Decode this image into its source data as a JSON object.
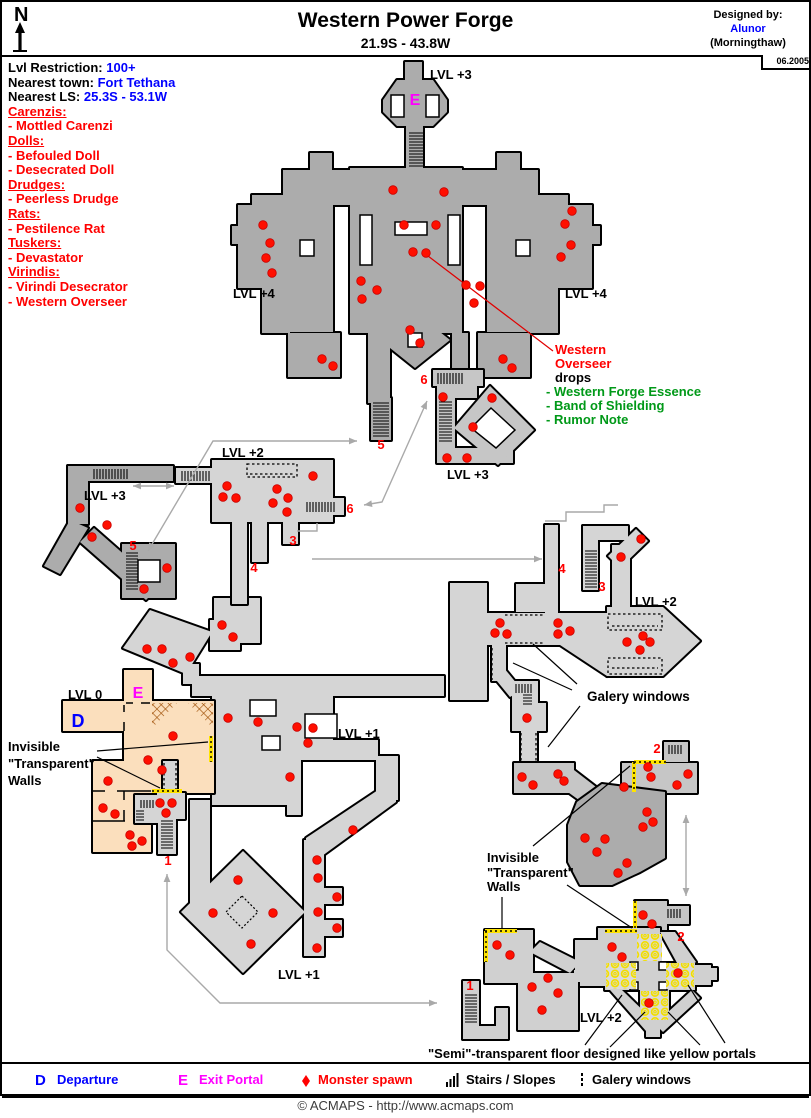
{
  "header": {
    "compass": "N",
    "title": "Western Power Forge",
    "coords": "21.9S - 43.8W",
    "designed_by": "Designed by:",
    "designer": "Alunor",
    "designer_world": "(Morningthaw)",
    "date": "06.2005"
  },
  "info": {
    "restriction_label": "Lvl Restriction:",
    "restriction": "100+",
    "town_label": "Nearest town:",
    "town": "Fort Tethana",
    "ls_label": "Nearest LS:",
    "ls": "25.3S - 53.1W"
  },
  "bestiary": [
    {
      "heading": "Carenzis:",
      "items": [
        "- Mottled Carenzi"
      ]
    },
    {
      "heading": "Dolls:",
      "items": [
        "- Befouled Doll",
        "- Desecrated Doll"
      ]
    },
    {
      "heading": "Drudges:",
      "items": [
        "- Peerless Drudge"
      ]
    },
    {
      "heading": "Rats:",
      "items": [
        "- Pestilence Rat"
      ]
    },
    {
      "heading": "Tuskers:",
      "items": [
        "- Devastator"
      ]
    },
    {
      "heading": "Virindis:",
      "items": [
        "- Virindi Desecrator",
        "- Western Overseer"
      ]
    }
  ],
  "annotations": {
    "overseer_name_1": "Western",
    "overseer_name_2": "Overseer",
    "overseer_drops_label": "drops",
    "overseer_drops": [
      "- Western Forge Essence",
      "- Band of Shielding",
      "- Rumor Note"
    ],
    "invisible_1": "Invisible",
    "invisible_2": "\"Transparent\"",
    "invisible_3": "Walls",
    "galery": "Galery windows",
    "semi_floor": "\"Semi\"-transparent floor designed like yellow portals"
  },
  "legend": {
    "departure_key": "D",
    "departure": "Departure",
    "exit_key": "E",
    "exit": "Exit Portal",
    "monster": "Monster spawn",
    "stairs": "Stairs / Slopes",
    "galery": "Galery windows"
  },
  "footer": {
    "copyright": "© ACMAPS - http://www.acmaps.com"
  },
  "map": {
    "colors": {
      "dark_gray": "#ACACAC",
      "mid_gray": "#C6C6C6",
      "light_gray": "#D5D5D5",
      "peach": "#FBDFBD",
      "spawn_red": "#FF0F00",
      "wall_yellow": "#FFE400",
      "arrow_gray": "#A9A9A9",
      "exit_magenta": "#FF00FF",
      "departure_blue": "#0000FF",
      "drops_green": "#009918"
    },
    "labels": [
      {
        "t": "LVL +3",
        "x": 430,
        "y": 79,
        "c": "k",
        "a": "s"
      },
      {
        "t": "LVL +4",
        "x": 233,
        "y": 298,
        "c": "k",
        "a": "s"
      },
      {
        "t": "LVL +4",
        "x": 565,
        "y": 298,
        "c": "k",
        "a": "s"
      },
      {
        "t": "LVL +3",
        "x": 447,
        "y": 479,
        "c": "k",
        "a": "s"
      },
      {
        "t": "LVL +3",
        "x": 84,
        "y": 500,
        "c": "k",
        "a": "s"
      },
      {
        "t": "LVL +2",
        "x": 222,
        "y": 457,
        "c": "k",
        "a": "s"
      },
      {
        "t": "LVL +2",
        "x": 635,
        "y": 606,
        "c": "k",
        "a": "s"
      },
      {
        "t": "LVL +1",
        "x": 338,
        "y": 738,
        "c": "k",
        "a": "s"
      },
      {
        "t": "LVL 0",
        "x": 68,
        "y": 699,
        "c": "k",
        "a": "s"
      },
      {
        "t": "LVL +1",
        "x": 278,
        "y": 979,
        "c": "k",
        "a": "s"
      },
      {
        "t": "LVL +2",
        "x": 580,
        "y": 1022,
        "c": "k",
        "a": "s"
      },
      {
        "t": "5",
        "x": 381,
        "y": 449,
        "c": "r",
        "a": "m"
      },
      {
        "t": "5",
        "x": 133,
        "y": 550,
        "c": "r",
        "a": "m"
      },
      {
        "t": "6",
        "x": 424,
        "y": 384,
        "c": "r",
        "a": "m"
      },
      {
        "t": "6",
        "x": 350,
        "y": 513,
        "c": "r",
        "a": "m"
      },
      {
        "t": "3",
        "x": 293,
        "y": 545,
        "c": "r",
        "a": "m"
      },
      {
        "t": "4",
        "x": 254,
        "y": 572,
        "c": "r",
        "a": "m"
      },
      {
        "t": "4",
        "x": 562,
        "y": 573,
        "c": "r",
        "a": "m"
      },
      {
        "t": "3",
        "x": 602,
        "y": 591,
        "c": "r",
        "a": "m"
      },
      {
        "t": "1",
        "x": 168,
        "y": 865,
        "c": "r",
        "a": "m"
      },
      {
        "t": "1",
        "x": 470,
        "y": 990,
        "c": "r",
        "a": "m"
      },
      {
        "t": "2",
        "x": 657,
        "y": 753,
        "c": "r",
        "a": "m"
      },
      {
        "t": "2",
        "x": 681,
        "y": 941,
        "c": "r",
        "a": "m"
      },
      {
        "t": "E",
        "x": 415,
        "y": 105,
        "c": "e",
        "a": "m"
      },
      {
        "t": "E",
        "x": 138,
        "y": 698,
        "c": "e",
        "a": "m"
      },
      {
        "t": "D",
        "x": 78,
        "y": 727,
        "c": "d",
        "a": "m"
      }
    ],
    "stairs": [
      [
        409,
        132,
        14,
        36,
        "v"
      ],
      [
        373,
        402,
        16,
        36,
        "v"
      ],
      [
        437,
        373,
        27,
        11,
        "h"
      ],
      [
        439,
        401,
        13,
        42,
        "v"
      ],
      [
        93,
        469,
        36,
        10,
        "h"
      ],
      [
        126,
        552,
        12,
        38,
        "v"
      ],
      [
        181,
        471,
        29,
        10,
        "h"
      ],
      [
        306,
        502,
        28,
        10,
        "h"
      ],
      [
        585,
        550,
        12,
        38,
        "v"
      ],
      [
        161,
        820,
        12,
        30,
        "v"
      ],
      [
        465,
        994,
        12,
        30,
        "v"
      ],
      [
        515,
        684,
        16,
        9,
        "h"
      ],
      [
        523,
        694,
        9,
        11,
        "v"
      ],
      [
        668,
        745,
        15,
        9,
        "h"
      ],
      [
        667,
        909,
        15,
        9,
        "h"
      ],
      [
        140,
        800,
        13,
        8,
        "h"
      ],
      [
        136,
        810,
        8,
        12,
        "v"
      ]
    ],
    "arrows": [
      {
        "pts": [
          [
            148,
            551
          ],
          [
            213,
            441
          ],
          [
            357,
            441
          ]
        ],
        "heads": "both"
      },
      {
        "pts": [
          [
            427,
            401
          ],
          [
            382,
            502
          ],
          [
            364,
            505
          ]
        ],
        "heads": "both"
      },
      {
        "pts": [
          [
            133,
            486
          ],
          [
            174,
            486
          ]
        ],
        "heads": "both"
      },
      {
        "pts": [
          [
            312,
            559
          ],
          [
            542,
            559
          ]
        ],
        "heads": "end"
      },
      {
        "pts": [
          [
            297,
            531
          ],
          [
            317,
            531
          ],
          [
            317,
            523
          ]
        ],
        "heads": "none"
      },
      {
        "pts": [
          [
            545,
            521
          ],
          [
            566,
            521
          ],
          [
            566,
            512
          ],
          [
            604,
            512
          ],
          [
            604,
            505
          ],
          [
            618,
            505
          ]
        ],
        "heads": "none"
      },
      {
        "pts": [
          [
            686,
            815
          ],
          [
            686,
            896
          ]
        ],
        "heads": "both"
      },
      {
        "pts": [
          [
            167,
            874
          ],
          [
            167,
            950
          ],
          [
            220,
            1003
          ],
          [
            437,
            1003
          ]
        ],
        "heads": "both"
      }
    ],
    "lines": [
      {
        "pts": [
          [
            97,
            751
          ],
          [
            208,
            742
          ]
        ],
        "c": "#000000"
      },
      {
        "pts": [
          [
            97,
            757
          ],
          [
            160,
            788
          ]
        ],
        "c": "#000000"
      },
      {
        "pts": [
          [
            533,
            846
          ],
          [
            630,
            766
          ]
        ],
        "c": "#000000"
      },
      {
        "pts": [
          [
            567,
            885
          ],
          [
            632,
            928
          ]
        ],
        "c": "#000000"
      },
      {
        "pts": [
          [
            502,
            897
          ],
          [
            502,
            928
          ]
        ],
        "c": "#000000"
      },
      {
        "pts": [
          [
            577,
            684
          ],
          [
            533,
            644
          ]
        ],
        "c": "#000000"
      },
      {
        "pts": [
          [
            572,
            690
          ],
          [
            513,
            663
          ]
        ],
        "c": "#000000"
      },
      {
        "pts": [
          [
            580,
            706
          ],
          [
            548,
            747
          ]
        ],
        "c": "#000000"
      },
      {
        "pts": [
          [
            622,
            995
          ],
          [
            585,
            1045
          ]
        ],
        "c": "#000000"
      },
      {
        "pts": [
          [
            645,
            1012
          ],
          [
            610,
            1047
          ]
        ],
        "c": "#000000"
      },
      {
        "pts": [
          [
            668,
            1012
          ],
          [
            700,
            1045
          ]
        ],
        "c": "#000000"
      },
      {
        "pts": [
          [
            688,
            985
          ],
          [
            725,
            1043
          ]
        ],
        "c": "#000000"
      },
      {
        "pts": [
          [
            428,
            256
          ],
          [
            553,
            351
          ]
        ],
        "c": "#E10000"
      }
    ],
    "spawns": [
      [
        393,
        190
      ],
      [
        444,
        192
      ],
      [
        404,
        225
      ],
      [
        436,
        225
      ],
      [
        413,
        252
      ],
      [
        426,
        253
      ],
      [
        263,
        225
      ],
      [
        270,
        243
      ],
      [
        266,
        258
      ],
      [
        272,
        273
      ],
      [
        361,
        281
      ],
      [
        377,
        290
      ],
      [
        362,
        299
      ],
      [
        466,
        285
      ],
      [
        480,
        286
      ],
      [
        474,
        303
      ],
      [
        572,
        211
      ],
      [
        565,
        224
      ],
      [
        571,
        245
      ],
      [
        561,
        257
      ],
      [
        410,
        330
      ],
      [
        420,
        343
      ],
      [
        322,
        359
      ],
      [
        333,
        366
      ],
      [
        503,
        359
      ],
      [
        512,
        368
      ],
      [
        443,
        397
      ],
      [
        492,
        398
      ],
      [
        473,
        427
      ],
      [
        447,
        458
      ],
      [
        467,
        458
      ],
      [
        80,
        508
      ],
      [
        107,
        525
      ],
      [
        92,
        537
      ],
      [
        167,
        568
      ],
      [
        144,
        589
      ],
      [
        227,
        486
      ],
      [
        223,
        497
      ],
      [
        236,
        498
      ],
      [
        277,
        489
      ],
      [
        273,
        503
      ],
      [
        288,
        498
      ],
      [
        287,
        512
      ],
      [
        313,
        476
      ],
      [
        147,
        649
      ],
      [
        162,
        649
      ],
      [
        173,
        663
      ],
      [
        190,
        657
      ],
      [
        222,
        625
      ],
      [
        233,
        637
      ],
      [
        228,
        718
      ],
      [
        258,
        722
      ],
      [
        297,
        727
      ],
      [
        313,
        728
      ],
      [
        308,
        743
      ],
      [
        290,
        777
      ],
      [
        173,
        736
      ],
      [
        148,
        760
      ],
      [
        162,
        770
      ],
      [
        108,
        781
      ],
      [
        103,
        808
      ],
      [
        115,
        814
      ],
      [
        130,
        835
      ],
      [
        142,
        841
      ],
      [
        132,
        846
      ],
      [
        160,
        803
      ],
      [
        172,
        803
      ],
      [
        166,
        813
      ],
      [
        353,
        830
      ],
      [
        317,
        860
      ],
      [
        318,
        878
      ],
      [
        337,
        897
      ],
      [
        318,
        912
      ],
      [
        337,
        928
      ],
      [
        317,
        948
      ],
      [
        238,
        880
      ],
      [
        213,
        913
      ],
      [
        273,
        913
      ],
      [
        251,
        944
      ],
      [
        500,
        623
      ],
      [
        495,
        633
      ],
      [
        507,
        634
      ],
      [
        558,
        623
      ],
      [
        570,
        631
      ],
      [
        558,
        634
      ],
      [
        627,
        642
      ],
      [
        643,
        636
      ],
      [
        650,
        642
      ],
      [
        640,
        650
      ],
      [
        621,
        557
      ],
      [
        641,
        539
      ],
      [
        527,
        718
      ],
      [
        522,
        777
      ],
      [
        533,
        785
      ],
      [
        558,
        774
      ],
      [
        564,
        781
      ],
      [
        648,
        767
      ],
      [
        624,
        787
      ],
      [
        651,
        777
      ],
      [
        677,
        785
      ],
      [
        688,
        774
      ],
      [
        647,
        812
      ],
      [
        653,
        822
      ],
      [
        643,
        827
      ],
      [
        585,
        838
      ],
      [
        605,
        839
      ],
      [
        597,
        852
      ],
      [
        627,
        863
      ],
      [
        618,
        873
      ],
      [
        497,
        945
      ],
      [
        510,
        955
      ],
      [
        548,
        978
      ],
      [
        532,
        987
      ],
      [
        558,
        993
      ],
      [
        542,
        1010
      ],
      [
        612,
        947
      ],
      [
        622,
        957
      ],
      [
        678,
        973
      ],
      [
        649,
        1003
      ],
      [
        643,
        915
      ],
      [
        652,
        924
      ]
    ]
  }
}
